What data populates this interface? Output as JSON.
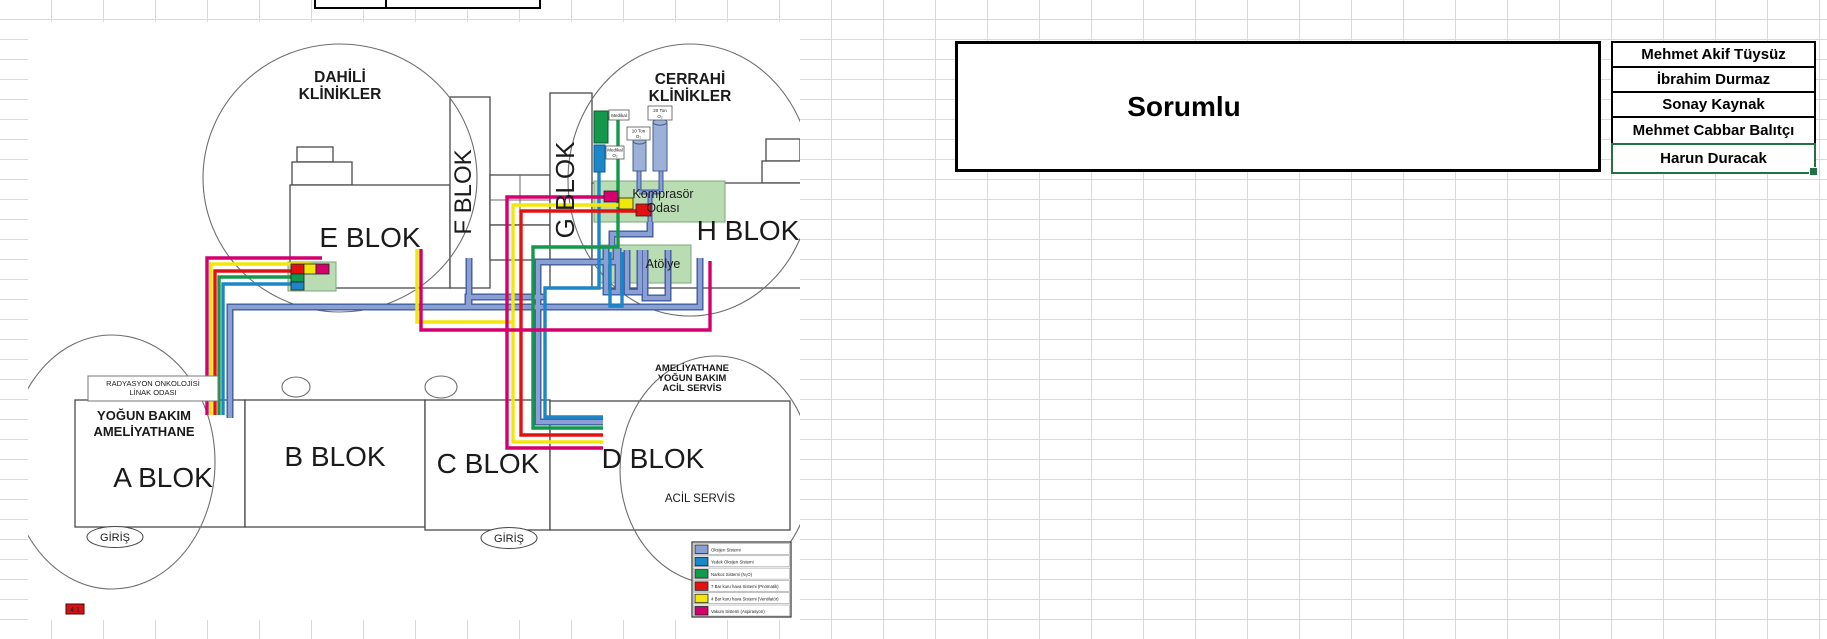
{
  "sheet": {
    "sorumlu_title": "Sorumlu",
    "names": [
      "Mehmet Akif Tüysüz",
      "İbrahim Durmaz",
      "Sonay Kaynak",
      "Mehmet Cabbar Balıtçı",
      "Harun Duracak"
    ]
  },
  "map": {
    "zones": {
      "dahili_line1": "DAHİLİ",
      "dahili_line2": "KLİNİKLER",
      "cerrahi_line1": "CERRAHİ",
      "cerrahi_line2": "KLİNİKLER",
      "amel_line1": "AMELİYATHANE",
      "amel_line2": "YOĞUN BAKIM",
      "amel_line3": "ACİL SERVİS"
    },
    "blocks": {
      "a": "A BLOK",
      "b": "B BLOK",
      "c": "C BLOK",
      "d": "D BLOK",
      "e": "E BLOK",
      "f": "F BLOK",
      "g": "G BLOK",
      "h": "H BLOK"
    },
    "rooms": {
      "komprasor_line1": "Komprasör",
      "komprasor_line2": "Odası",
      "atolye": "Atölye",
      "radyasyon_line1": "RADYASYON ONKOLOJİSİ",
      "radyasyon_line2": "LİNAK ODASI",
      "yogun_line1": "YOĞUN BAKIM",
      "yogun_line2": "AMELİYATHANE",
      "acil": "ACİL SERVİS"
    },
    "entrances": [
      "GİRİŞ",
      "GİRİŞ"
    ],
    "equipment": {
      "tank1_line1": "10 Ton",
      "tank1_line2": "O₂",
      "tank2_line1": "20 Ton",
      "tank2_line2": "O₂",
      "green_bar_label": "Medikal",
      "blue_bar_label_line1": "Medikal",
      "blue_bar_label_line2": "O₂"
    },
    "note": "4.1",
    "legend": [
      {
        "label": "Oksijen Sistemi",
        "color": "#8b9fd4"
      },
      {
        "label": "Yedek Oksijen Sistemi",
        "color": "#1b86c8"
      },
      {
        "label": "Narkoz Sistemi (N₂O)",
        "color": "#14994c"
      },
      {
        "label": "7 Bar kuru hava Sistemi (Pnömatik)",
        "color": "#e31212"
      },
      {
        "label": "4 Bar kuru hava Sistemi (Ventilatör)",
        "color": "#f2e70c"
      },
      {
        "label": "Vakum Sistemi (Aspirasyon)",
        "color": "#d4006d"
      }
    ]
  }
}
